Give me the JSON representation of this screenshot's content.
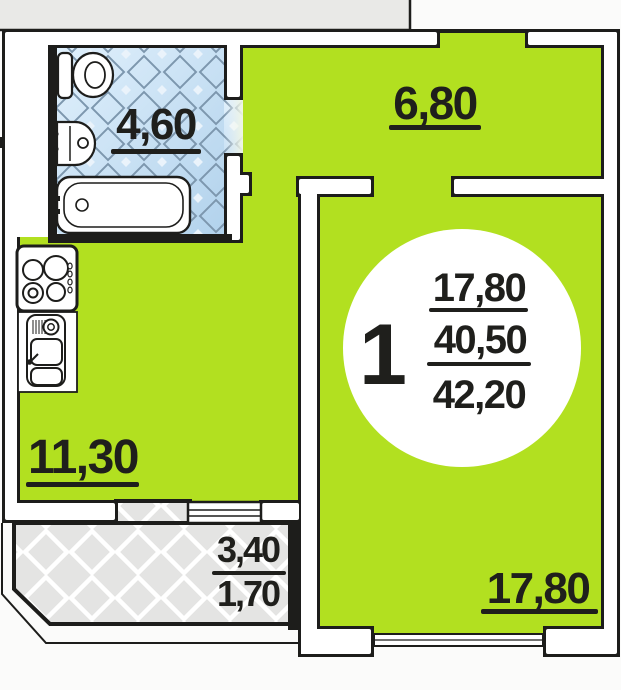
{
  "unit": {
    "number": "1",
    "living_area": "17,80",
    "area_without_balcony": "40,50",
    "total_area": "42,20"
  },
  "rooms": {
    "bathroom": {
      "area": "4,60"
    },
    "hallway": {
      "area": "6,80"
    },
    "kitchen": {
      "area": "11,30"
    },
    "living_room": {
      "area": "17,80"
    },
    "balcony": {
      "area": "3,40",
      "area_reduced": "1,70"
    }
  },
  "colors": {
    "floor": "#b2e020",
    "bathroom_tile": "#c9def2",
    "balcony_floor": "#e4e4e3",
    "stairwell": "#e9e9e7",
    "walls": "#1d1d1b",
    "text": "#1f1f1c"
  }
}
